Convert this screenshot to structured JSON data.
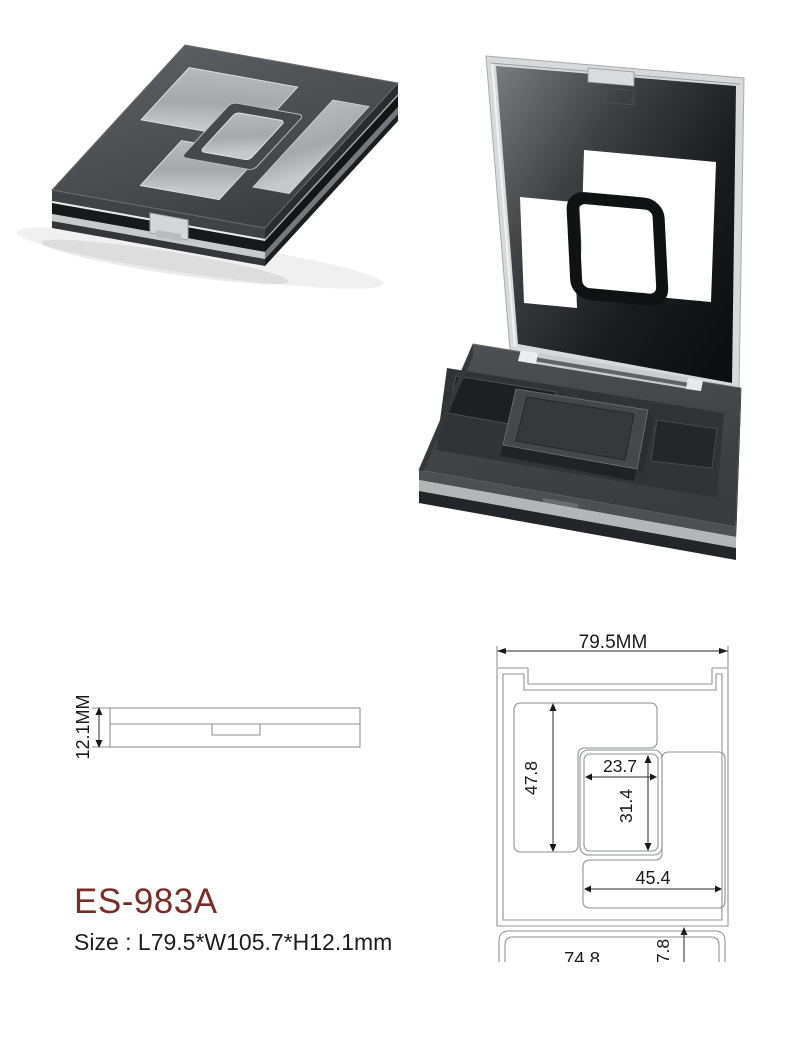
{
  "product": {
    "code": "ES-983A",
    "size": "Size : L79.5*W105.7*H12.1mm"
  },
  "side_view": {
    "height": "12.1MM"
  },
  "top_view": {
    "overall_width": "79.5MM",
    "left_pan_height": "47.8",
    "middle_pan_width": "23.7",
    "middle_pan_height": "31.4",
    "right_pan_width": "45.4",
    "lid_width": "74.8",
    "hinge_offset": "7.8"
  },
  "photos": {
    "closed": "closed-compact-angled-photo",
    "open": "open-compact-photo"
  },
  "colors": {
    "product_code": "#7b2c27",
    "drawing_line": "#8f9294",
    "dimension_text": "#1a1a1a",
    "case_dark": "#3e4244",
    "window_translucent": "#a9adae"
  }
}
